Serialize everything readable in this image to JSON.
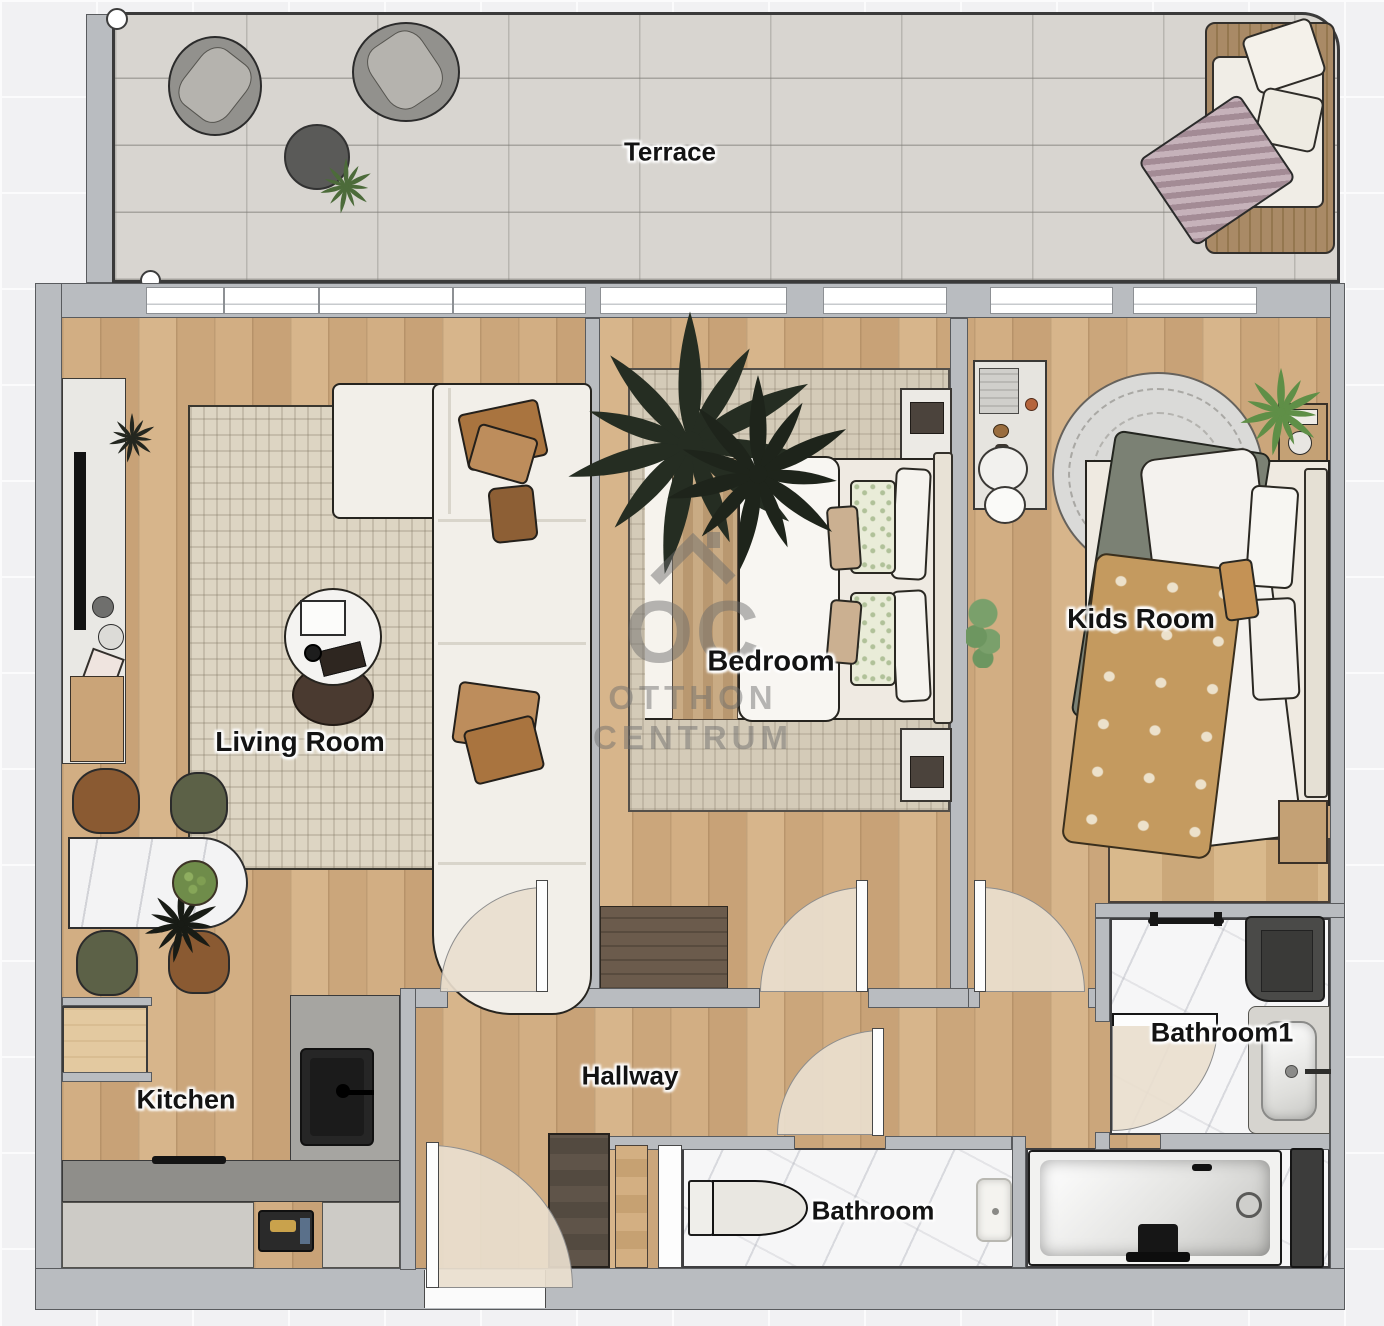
{
  "watermark": {
    "logo_text": "OC",
    "line1": "OTTHON",
    "line2": "CENTRUM"
  },
  "rooms": {
    "terrace": {
      "label": "Terrace"
    },
    "living_room": {
      "label": "Living Room"
    },
    "bedroom": {
      "label": "Bedroom"
    },
    "kids_room": {
      "label": "Kids Room"
    },
    "kitchen": {
      "label": "Kitchen"
    },
    "hallway": {
      "label": "Hallway"
    },
    "bathroom": {
      "label": "Bathroom"
    },
    "bathroom1": {
      "label": "Bathroom1"
    }
  },
  "colors": {
    "wall": "#b9bcc0",
    "wood_floor": "#cfab80",
    "terrace_floor": "#d8d5d0",
    "marble_floor": "#f6f6f7",
    "rug": "#ddd5c3",
    "sofa": "#f2efe9",
    "pillow_brown": "#a9743f",
    "plant_dark": "#252d22",
    "plant_green": "#5f8f47",
    "dark_wood": "#6b5b4c"
  }
}
